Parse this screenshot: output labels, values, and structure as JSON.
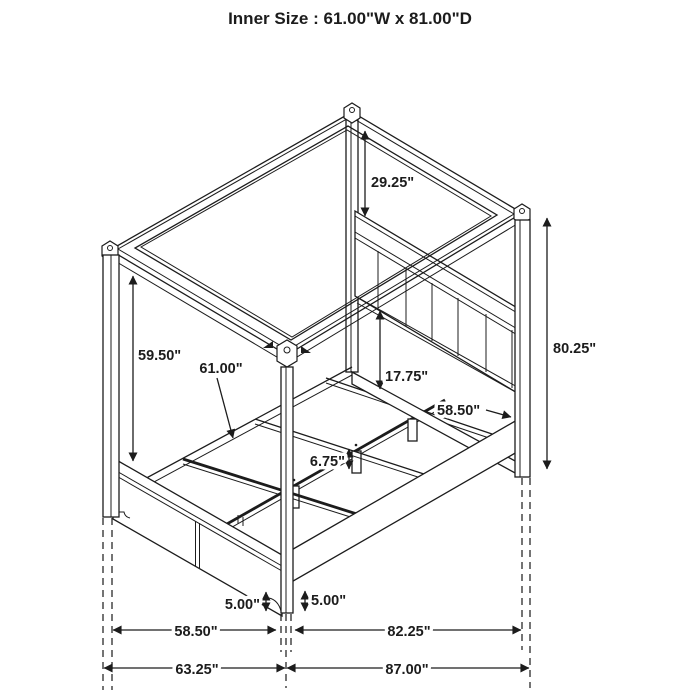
{
  "title": "Inner Size : 61.00\"W x 81.00\"D",
  "figure": {
    "type": "isometric line drawing",
    "subject": "four-poster canopy storage bed with footboard drawers"
  },
  "colors": {
    "ink": "#1c1c1c",
    "background": "#ffffff"
  },
  "dimensions": {
    "canopy_to_headboard": "29.25\"",
    "overall_height": "80.25\"",
    "canopy_to_footboard": "59.50\"",
    "inner_width": "61.00\"",
    "headboard_clearance": "17.75\"",
    "inner_depth": "58.50\"",
    "support_leg_height": "6.75\"",
    "foot_height_front": "5.00\"",
    "foot_height_side": "5.00\"",
    "footboard_width": "58.50\"",
    "overall_width": "63.25\"",
    "siderail_depth": "82.25\"",
    "overall_depth": "87.00\""
  }
}
